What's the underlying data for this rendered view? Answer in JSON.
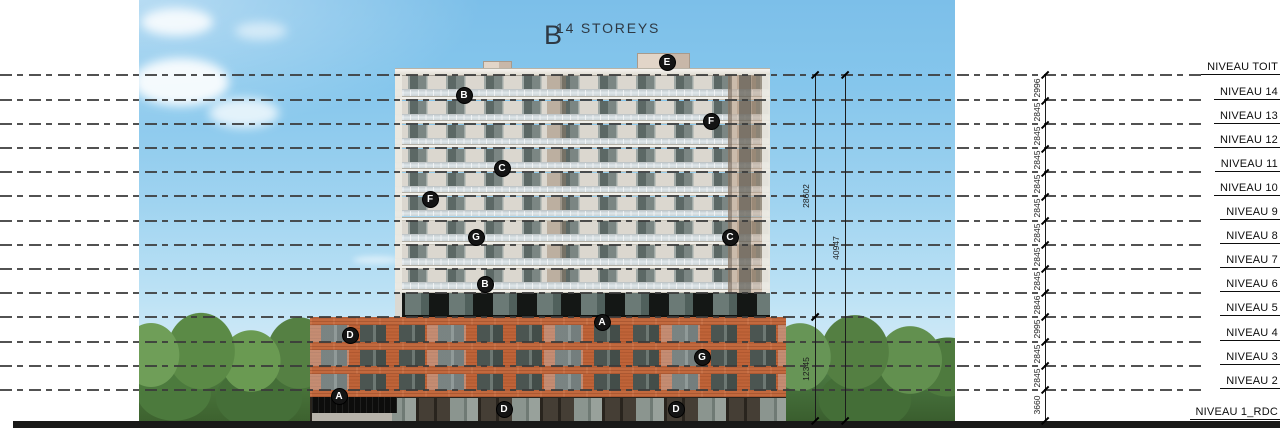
{
  "title": {
    "block": "B",
    "subtitle": "14 STOREYS"
  },
  "levels": [
    {
      "label": "NIVEAU TOIT",
      "y": 75,
      "dashed": true
    },
    {
      "label": "NIVEAU 14",
      "y": 100.3,
      "dashed": true
    },
    {
      "label": "NIVEAU 13",
      "y": 124.3,
      "dashed": true
    },
    {
      "label": "NIVEAU 12",
      "y": 148.4,
      "dashed": true
    },
    {
      "label": "NIVEAU 11",
      "y": 172.4,
      "dashed": true
    },
    {
      "label": "NIVEAU 10",
      "y": 196.4,
      "dashed": true
    },
    {
      "label": "NIVEAU 9",
      "y": 220.5,
      "dashed": true
    },
    {
      "label": "NIVEAU 8",
      "y": 244.5,
      "dashed": true
    },
    {
      "label": "NIVEAU 7",
      "y": 268.5,
      "dashed": true
    },
    {
      "label": "NIVEAU 6",
      "y": 292.6,
      "dashed": true
    },
    {
      "label": "NIVEAU 5",
      "y": 316.6,
      "dashed": true
    },
    {
      "label": "NIVEAU 4",
      "y": 341.9,
      "dashed": true
    },
    {
      "label": "NIVEAU 3",
      "y": 365.9,
      "dashed": true
    },
    {
      "label": "NIVEAU 2",
      "y": 389.9,
      "dashed": true
    },
    {
      "label": "NIVEAU 1_RDC",
      "y": 420.9,
      "dashed": false
    }
  ],
  "storey_dims": [
    "2996",
    "2845",
    "2845",
    "2845",
    "2845",
    "2845",
    "2845",
    "2845",
    "2845",
    "2846",
    "2995",
    "2845",
    "2845",
    "3660"
  ],
  "chain_x": 1045,
  "span_dims": [
    {
      "value": "28602",
      "from_level": 0,
      "to_level": 10,
      "x": 815
    },
    {
      "value": "12345",
      "from_level": 10,
      "to_level": 14,
      "x": 815
    },
    {
      "value": "40947",
      "from_level": 0,
      "to_level": 14,
      "x": 845
    }
  ],
  "markers": [
    {
      "letter": "E",
      "x": 667,
      "y": 62
    },
    {
      "letter": "B",
      "x": 464,
      "y": 95
    },
    {
      "letter": "F",
      "x": 711,
      "y": 121
    },
    {
      "letter": "C",
      "x": 502,
      "y": 168
    },
    {
      "letter": "F",
      "x": 430,
      "y": 199
    },
    {
      "letter": "G",
      "x": 476,
      "y": 237
    },
    {
      "letter": "C",
      "x": 730,
      "y": 237
    },
    {
      "letter": "B",
      "x": 485,
      "y": 284
    },
    {
      "letter": "A",
      "x": 602,
      "y": 322
    },
    {
      "letter": "D",
      "x": 350,
      "y": 335
    },
    {
      "letter": "G",
      "x": 702,
      "y": 357
    },
    {
      "letter": "A",
      "x": 339,
      "y": 396
    },
    {
      "letter": "D",
      "x": 504,
      "y": 409
    },
    {
      "letter": "D",
      "x": 676,
      "y": 409
    }
  ],
  "colors": {
    "sky_top": "#7cbfe9",
    "sky_horizon": "#eaf6fb",
    "tree_green": "#5b8a46",
    "tower_wall": "#dbd7cf",
    "tower_glass": "#5c6865",
    "balcony_glass": "#e0e7ea",
    "tower_tan_section": "#bca087",
    "brick": "#c2693e",
    "storefront_dark": "#453e35",
    "ground_bar": "#191918",
    "annotation_line": "#3a3a3a",
    "marker_bg": "#141414",
    "marker_text": "#ffffff",
    "title_text": "#2e3944"
  }
}
